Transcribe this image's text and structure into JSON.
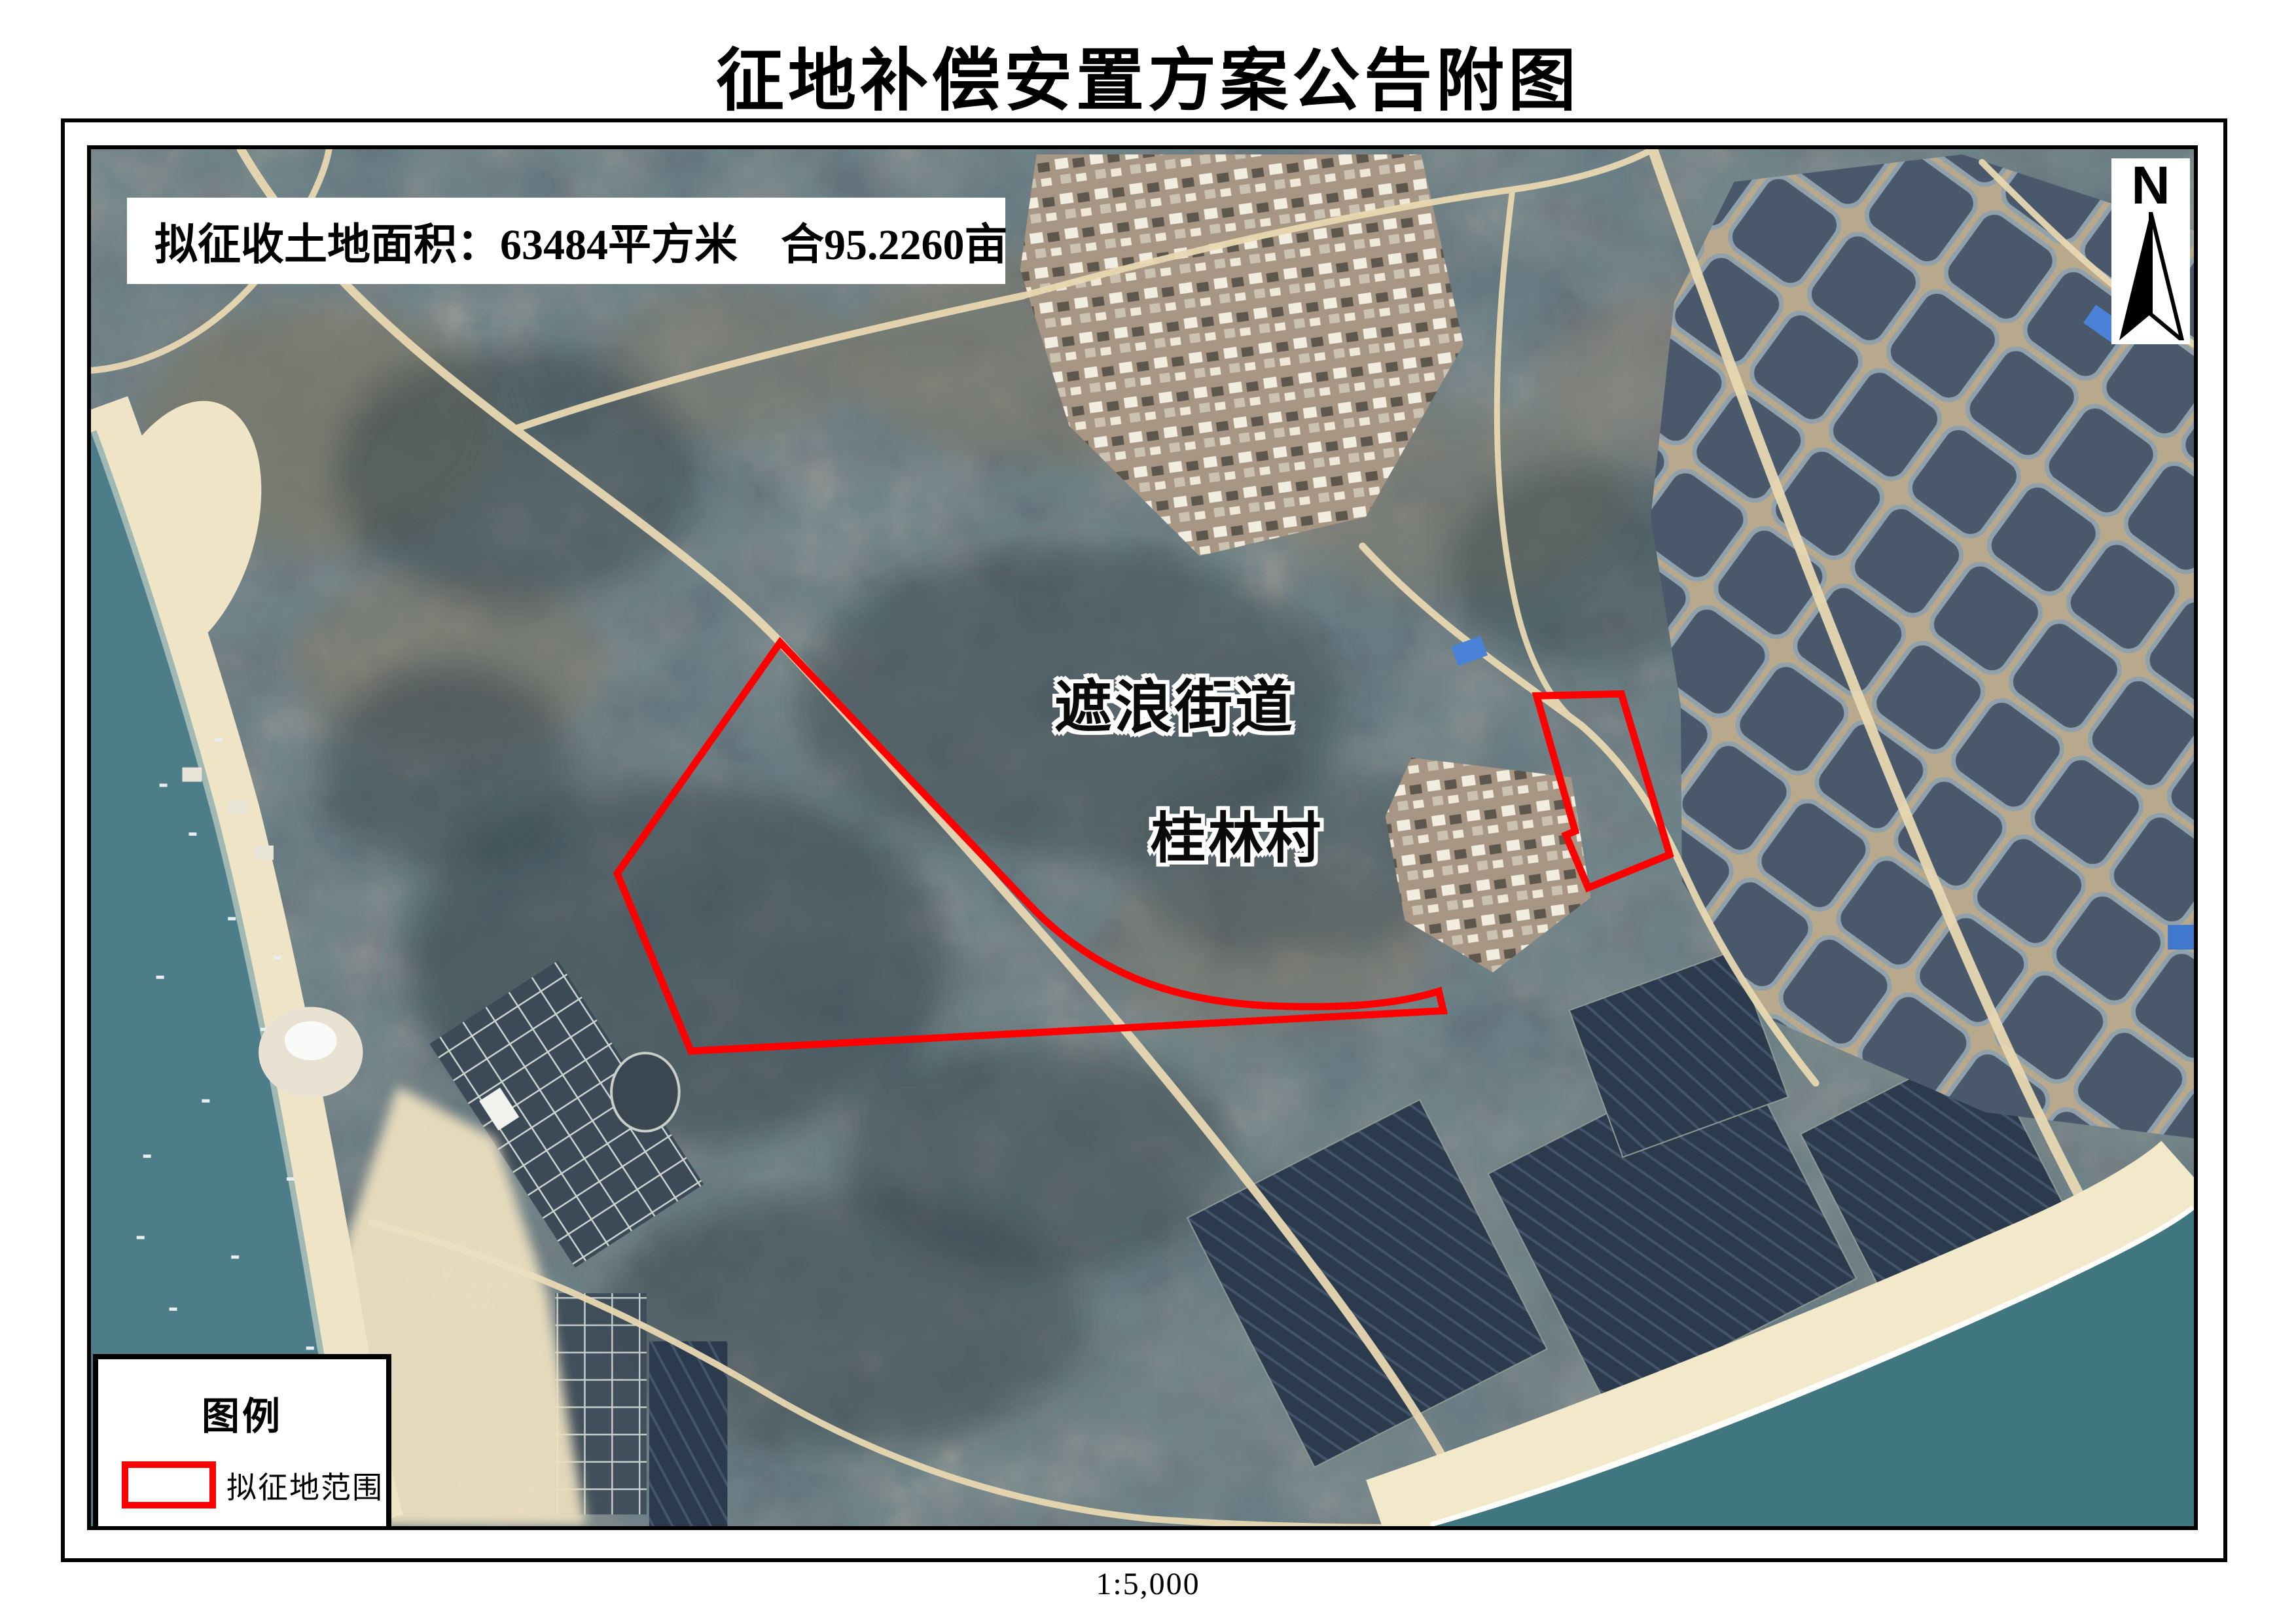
{
  "title": "征地补偿安置方案公告附图",
  "map": {
    "info_box_text": "拟征收土地面积：63484平方米　合95.2260亩",
    "north_label": "N",
    "street_label": "遮浪街道",
    "village_label": "桂林村"
  },
  "legend": {
    "title": "图例",
    "items": [
      {
        "label": "拟征地范围",
        "swatch_color": "#ff0000"
      }
    ]
  },
  "scale_text": "1:5,000",
  "colors": {
    "boundary": "#ff0000",
    "sea_bay": "#4e7d8a",
    "sea_south": "#3f7680",
    "beach": "#efe4c6",
    "land": "#64727b",
    "frame": "#000000"
  }
}
